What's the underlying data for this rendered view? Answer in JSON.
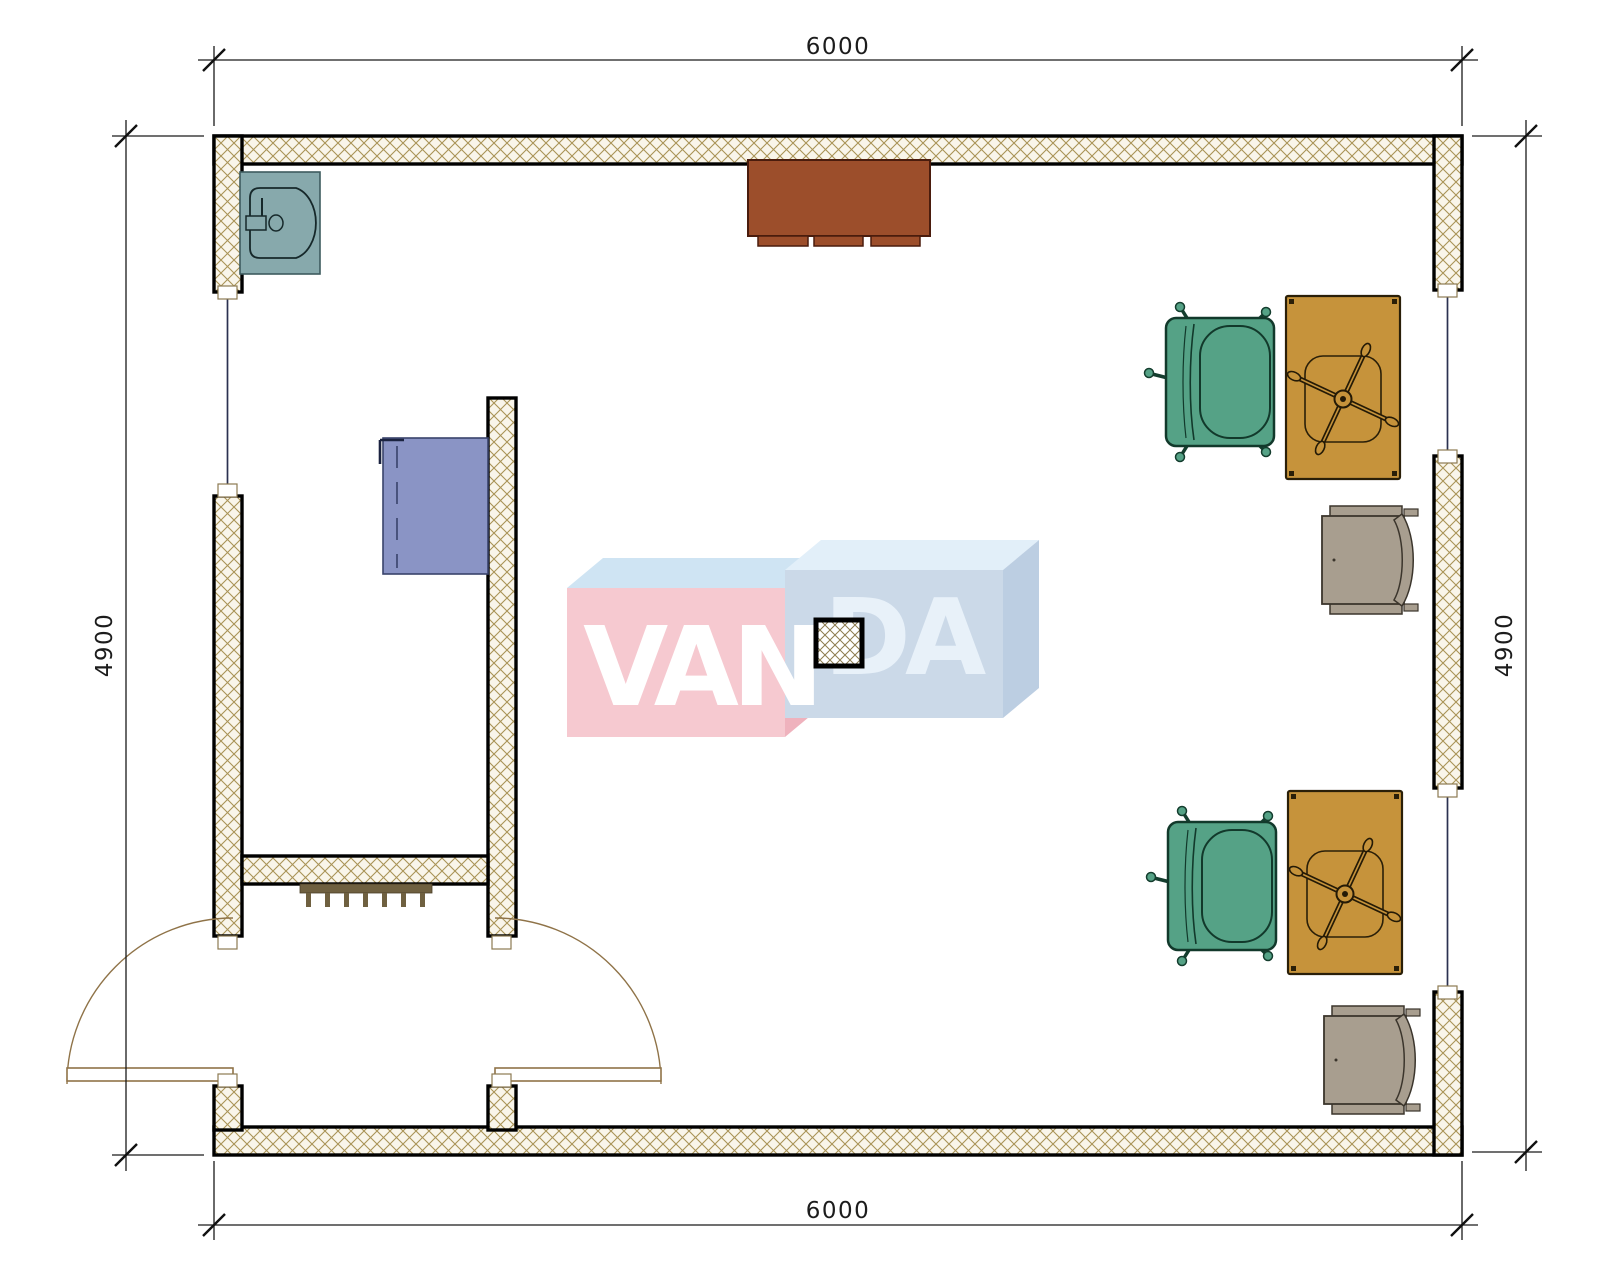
{
  "page": {
    "kind": "architectural floor plan drawing",
    "background": "#ffffff"
  },
  "dimensions": {
    "top": "6000",
    "bottom": "6000",
    "left": "4900",
    "right": "4900"
  },
  "watermark": {
    "brand": "VANDA",
    "left_text": "VAN",
    "right_text": "DA",
    "left_cube_front": "#F6C9D0",
    "left_cube_top": "#CFE4F3",
    "left_cube_side": "#EFB2BD",
    "right_cube_front": "#CBD9E8",
    "right_cube_top": "#E2EFF9",
    "right_cube_side": "#BCCEE2",
    "van_color": "#FFFFFF",
    "da_color": "#E8F1F9"
  },
  "plan": {
    "walls": {
      "style": "diamond cross-hatch",
      "hatch_line_color": "#A99356",
      "hatch_bg_color": "#F9F5EA",
      "outline_color": "#000000"
    },
    "fixtures": [
      {
        "name": "sink",
        "color": "#87A9AC",
        "location": "top-left corner"
      },
      {
        "name": "sideboard-cabinet",
        "color": "#9C4E2B",
        "location": "top wall center"
      },
      {
        "name": "side-desk",
        "color": "#8A94C5",
        "location": "vestibule"
      },
      {
        "name": "column",
        "style": "cross-hatch",
        "location": "room center"
      },
      {
        "name": "radiator",
        "color": "#6F6040",
        "location": "vestibule partition"
      },
      {
        "name": "office-armchair",
        "color": "#55A286",
        "count": 2
      },
      {
        "name": "desk-with-task-chair",
        "color": "#C6933B",
        "count": 2
      },
      {
        "name": "side-chair",
        "color": "#A89E8F",
        "count": 2
      },
      {
        "name": "double-swing-door",
        "color": "#8F7348",
        "location": "bottom-left"
      },
      {
        "name": "window",
        "count": 3
      }
    ]
  }
}
